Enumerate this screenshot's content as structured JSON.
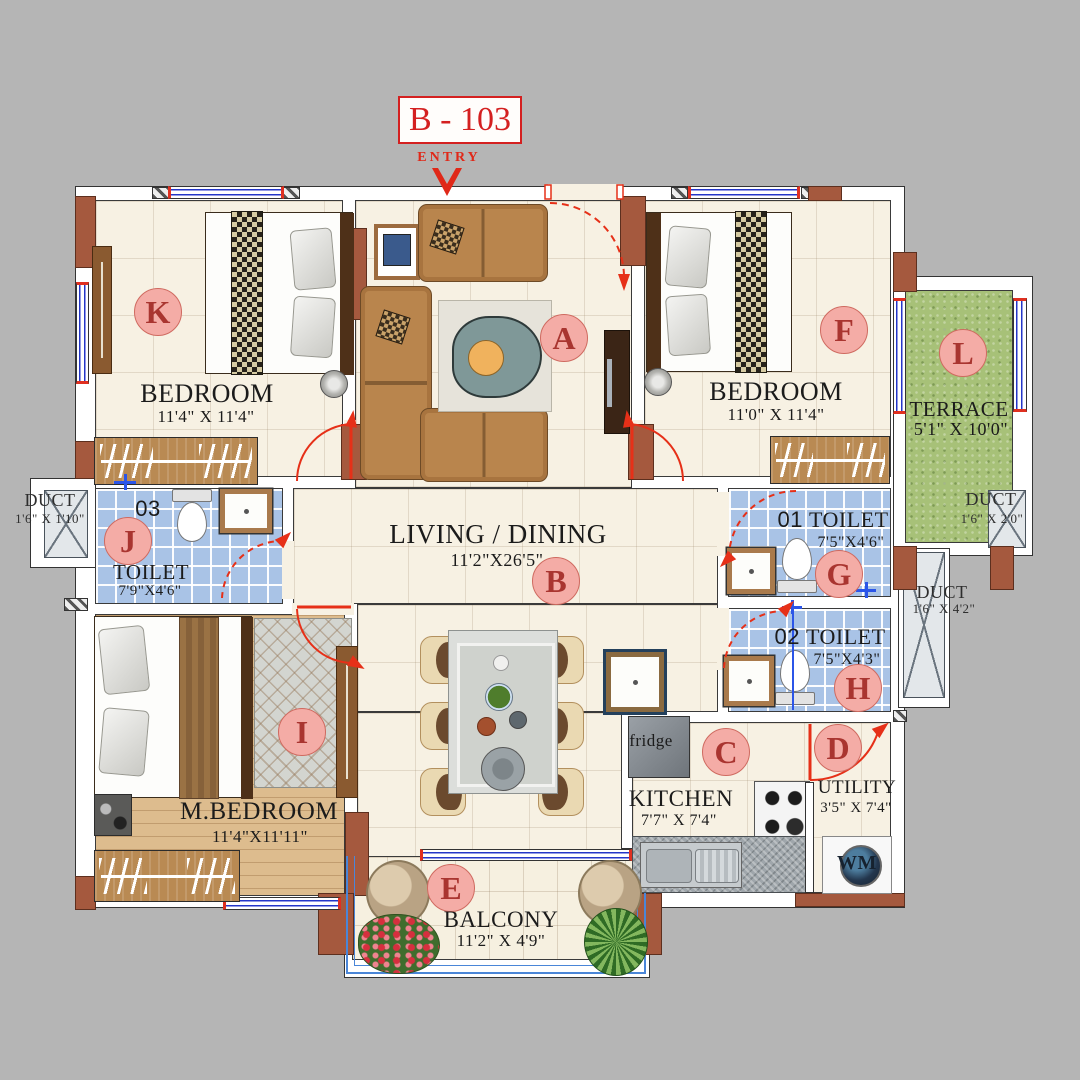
{
  "unit": {
    "number": "B - 103",
    "entry_label": "ENTRY"
  },
  "rooms": {
    "living": {
      "tag": "A",
      "tag2": "B",
      "name": "LIVING / DINING",
      "dims": "11'2\"X26'5\""
    },
    "bedroom_k": {
      "tag": "K",
      "name": "BEDROOM",
      "dims": "11'4\" X 11'4\""
    },
    "bedroom_f": {
      "tag": "F",
      "name": "BEDROOM",
      "dims": "11'0\" X 11'4\""
    },
    "master_bedroom": {
      "tag": "I",
      "name": "M.BEDROOM",
      "dims": "11'4\"X11'11\""
    },
    "terrace": {
      "tag": "L",
      "name": "TERRACE",
      "dims": "5'1\" X 10'0\""
    },
    "toilet_03": {
      "tag": "J",
      "number": "03",
      "name": "TOILET",
      "dims": "7'9\"X4'6\""
    },
    "toilet_01": {
      "tag": "G",
      "number": "01",
      "name": "TOILET",
      "dims": "7'5\"X4'6\""
    },
    "toilet_02": {
      "tag": "H",
      "number": "02",
      "name": "TOILET",
      "dims": "7'5\"X4'3\""
    },
    "kitchen": {
      "tag": "C",
      "name": "KITCHEN",
      "dims": "7'7\" X 7'4\"",
      "fridge_label": "fridge"
    },
    "utility": {
      "tag": "D",
      "name": "UTILITY",
      "dims": "3'5\" X 7'4\"",
      "wm_label": "WM"
    },
    "balcony": {
      "tag": "E",
      "name": "BALCONY",
      "dims": "11'2\" X 4'9\""
    },
    "duct_left": {
      "name": "DUCT",
      "dims": "1'6\" X 1'10\""
    },
    "duct_right_upper": {
      "name": "DUCT",
      "dims": "1'6\" X 2'0\""
    },
    "duct_right_lower": {
      "name": "DUCT",
      "dims": "1'6\" X 4'2\""
    }
  },
  "colors": {
    "background": "#b5b5b5",
    "wall_pillar": "#a5593e",
    "accent_red": "#e03020",
    "tile_blue": "#a9c3e6",
    "terrace_green": "#a7c178",
    "label_pink": "#f4aca6",
    "floor_cream": "#f7f1e3",
    "wood_floor": "#ddbc8e",
    "window_blue": "#2436c8"
  }
}
